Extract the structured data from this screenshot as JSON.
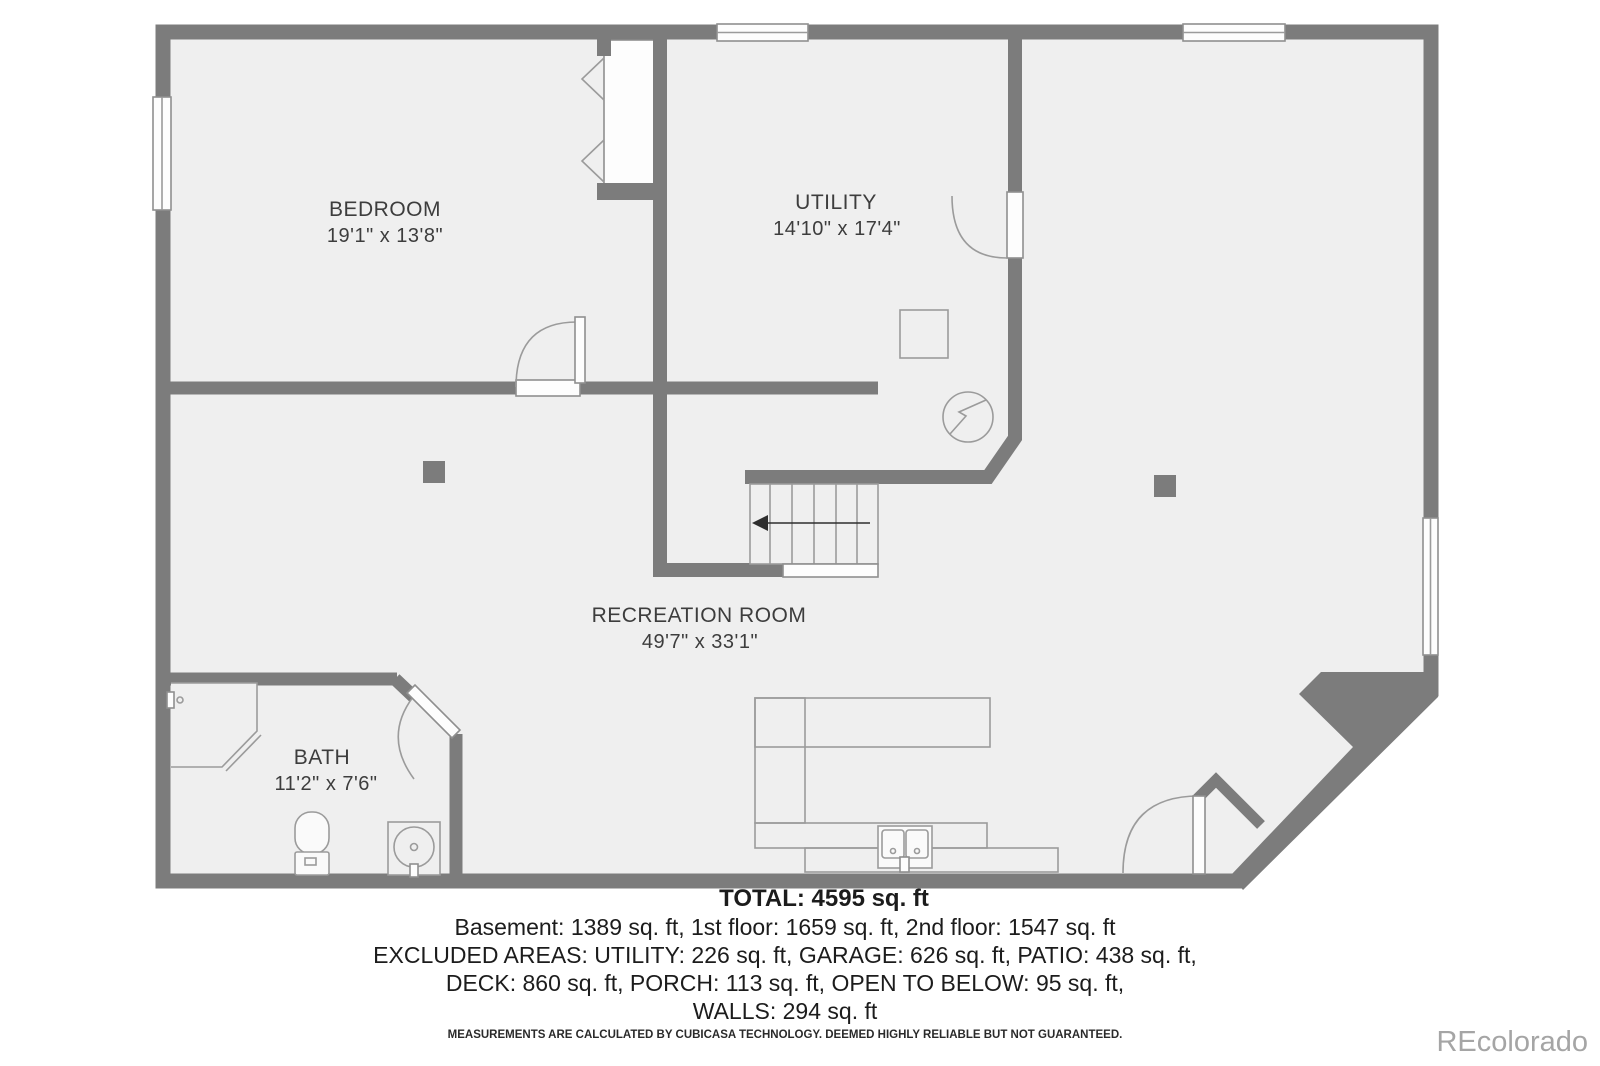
{
  "plan": {
    "rooms": [
      {
        "name": "BEDROOM",
        "dims": "19'1\" x 13'8\""
      },
      {
        "name": "UTILITY",
        "dims": "14'10\" x 17'4\""
      },
      {
        "name": "RECREATION ROOM",
        "dims": "49'7\" x 33'1\""
      },
      {
        "name": "BATH",
        "dims": "11'2\" x 7'6\""
      }
    ],
    "fixtures": [
      "stairs-with-down-arrow",
      "electrical-panel",
      "furnace-box",
      "shower",
      "toilet",
      "vanity-sink",
      "kitchenette-counter-with-sink",
      "support-columns",
      "windows",
      "doors"
    ]
  },
  "summary": {
    "total": "TOTAL: 4595 sq. ft",
    "floors": "Basement: 1389 sq. ft, 1st floor: 1659 sq. ft, 2nd floor: 1547 sq. ft",
    "excluded1": "EXCLUDED AREAS: UTILITY: 226 sq. ft, GARAGE: 626 sq. ft, PATIO: 438 sq. ft,",
    "excluded2": "DECK: 860 sq. ft, PORCH: 113 sq. ft, OPEN TO BELOW: 95 sq. ft,",
    "excluded3": "WALLS: 294 sq. ft",
    "disclaimer": "MEASUREMENTS ARE CALCULATED BY CUBICASA TECHNOLOGY. DEEMED HIGHLY RELIABLE BUT NOT GUARANTEED."
  },
  "watermark": "REcolorado",
  "colors": {
    "wall": "#7c7c7c",
    "floor": "#efefef",
    "outline": "#9b9b9b",
    "label_text": "#3d3d3d",
    "summary_text": "#1c1c1c",
    "watermark_text": "#a5a5a5",
    "background": "#ffffff"
  }
}
